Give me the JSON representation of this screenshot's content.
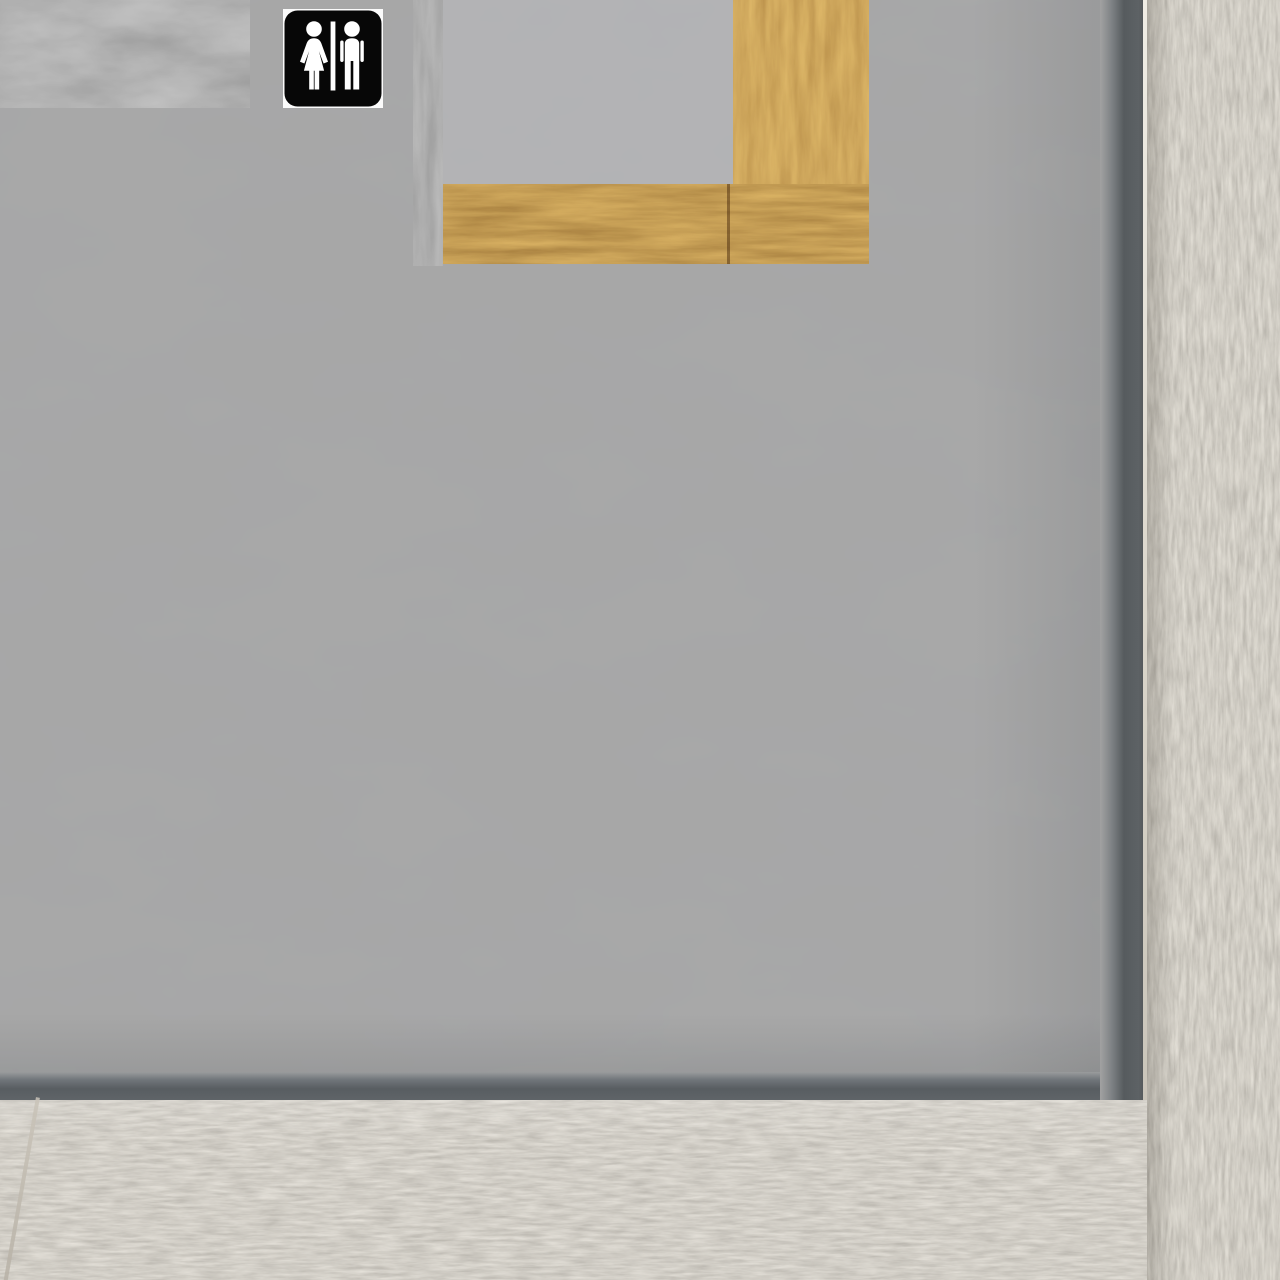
{
  "scene": {
    "title": "restroom-entrance-wall-view",
    "sign": {
      "label": "Restroom sign",
      "symbols": [
        "woman-symbol",
        "divider-bar",
        "man-symbol"
      ],
      "background": "#060606",
      "symbol_color": "#ffffff"
    },
    "colors": {
      "wall": "#a8a8a8",
      "recessed_panel": "#b3b3b5",
      "trim_dark": "#565b5e",
      "wood_orange_light": "#b06f28",
      "wood_orange_dark": "#744212",
      "wood_gray": "#6e6e6e",
      "concrete": "#aca69c",
      "edge_highlight": "#e9e5dc"
    }
  }
}
